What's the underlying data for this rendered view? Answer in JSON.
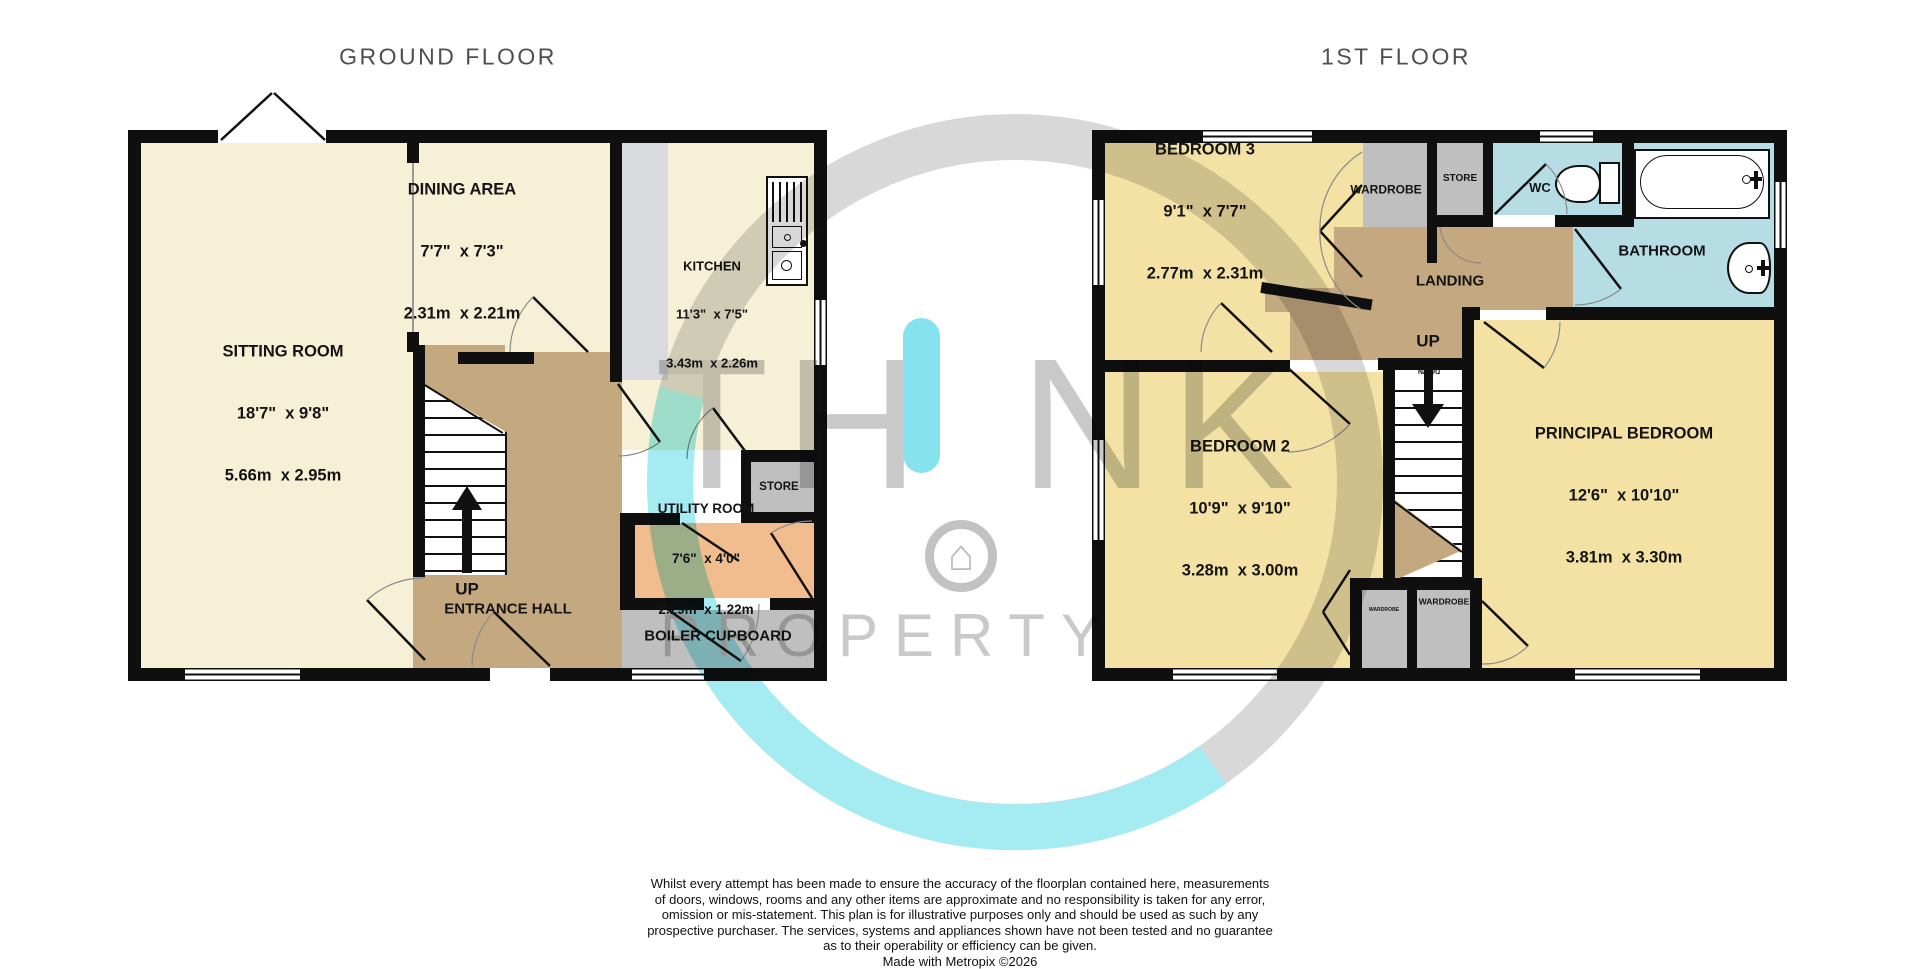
{
  "titles": {
    "ground": "GROUND FLOOR",
    "first": "1ST FLOOR"
  },
  "watermark": {
    "brand": "TH!NK",
    "brand_left": "TH",
    "brand_right": "NK",
    "brand_word": "PROPERTY",
    "accent_color": "#86e3ee",
    "gray_color": "#c9c9c9",
    "house_icon": "house-in-circle-icon"
  },
  "ground_floor": {
    "rooms": {
      "sitting_room": {
        "name": "SITTING ROOM",
        "imperial": "18'7\"  x 9'8\"",
        "metric": "5.66m  x 2.95m"
      },
      "dining_area": {
        "name": "DINING AREA",
        "imperial": "7'7\"  x 7'3\"",
        "metric": "2.31m  x 2.21m"
      },
      "kitchen": {
        "name": "KITCHEN",
        "imperial": "11'3\"  x 7'5\"",
        "metric": "3.43m  x 2.26m"
      },
      "utility_room": {
        "name": "UTILITY ROOM",
        "imperial": "7'6\"  x 4'0\"",
        "metric": "2.29m  x 1.22m"
      },
      "store": {
        "name": "STORE"
      },
      "boiler_cupboard": {
        "name": "BOILER CUPBOARD"
      },
      "entrance_hall": {
        "name": "ENTRANCE HALL"
      }
    },
    "stairs": {
      "label": "UP"
    }
  },
  "first_floor": {
    "rooms": {
      "bedroom_3": {
        "name": "BEDROOM 3",
        "imperial": "9'1\"  x 7'7\"",
        "metric": "2.77m  x 2.31m"
      },
      "bedroom_2": {
        "name": "BEDROOM 2",
        "imperial": "10'9\"  x 9'10\"",
        "metric": "3.28m  x 3.00m"
      },
      "principal_bedroom": {
        "name": "PRINCIPAL BEDROOM",
        "imperial": "12'6\"  x 10'10\"",
        "metric": "3.81m  x 3.30m"
      },
      "landing": {
        "name": "LANDING"
      },
      "wc": {
        "name": "WC"
      },
      "bathroom": {
        "name": "BATHROOM"
      },
      "store": {
        "name": "STORE"
      },
      "wardrobe_bedroom_3": {
        "name": "WARDROBE"
      },
      "wardrobe_bedroom_2": {
        "name": "WARDROBE"
      },
      "wardrobe_principal": {
        "name": "WARDROBE"
      }
    },
    "stairs": {
      "label": "UP",
      "down_label": "DOWN"
    }
  },
  "legend_colors": {
    "room_cream": "#f6f0d6",
    "room_yellow": "#f3e2a4",
    "hall_tan": "#c4a87f",
    "utility_salmon": "#f2bd8e",
    "cupboard_gray": "#bfbfbf",
    "bathroom_blue": "#b6dde4",
    "counter_gray": "#d9dade",
    "wall_black": "#0f0f0f"
  },
  "footer": {
    "lines": [
      "Whilst every attempt has been made to ensure the accuracy of the floorplan contained here, measurements",
      "of doors, windows, rooms and any other items are approximate and no responsibility is taken for any error,",
      "omission or mis-statement. This plan is for illustrative purposes only and should be used as such by any",
      "prospective purchaser. The services, systems and appliances shown have not been tested and no guarantee",
      "as to their operability or efficiency can be given.",
      "Made with Metropix ©2026"
    ]
  }
}
